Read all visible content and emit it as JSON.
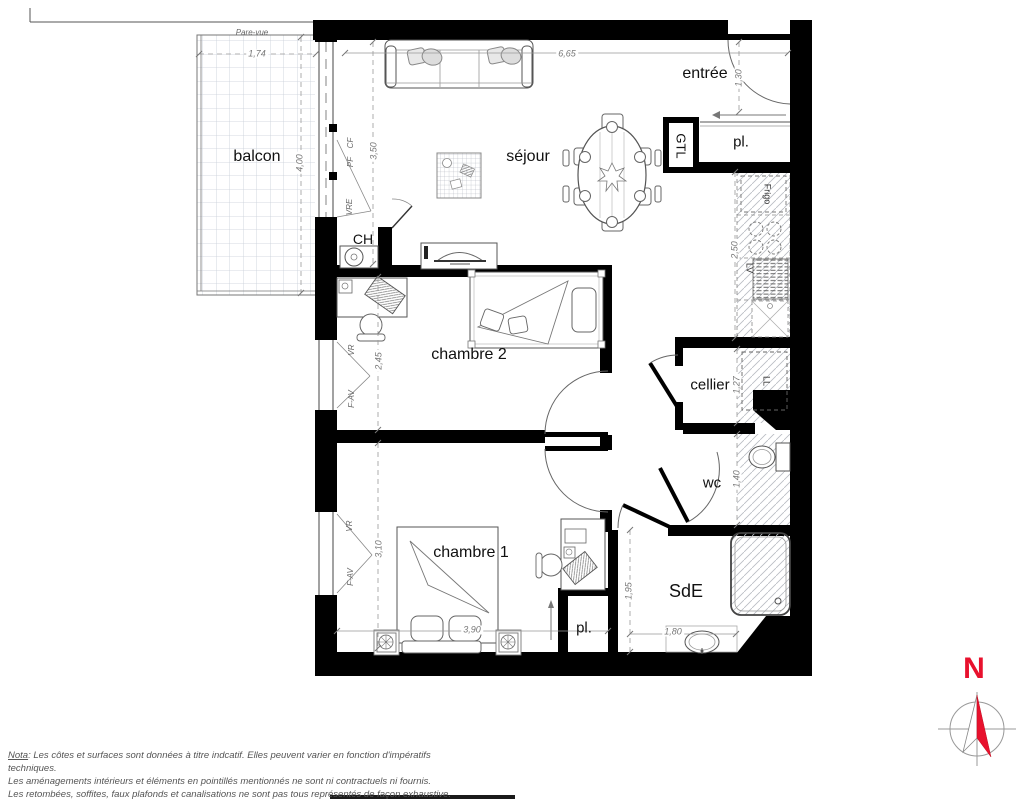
{
  "labels": {
    "balcon": "balcon",
    "sejour": "séjour",
    "entree": "entrée",
    "chambre2": "chambre 2",
    "chambre1": "chambre 1",
    "cellier": "cellier",
    "wc": "wc",
    "sde": "SdE",
    "pl_entree": "pl.",
    "pl_chambre1": "pl.",
    "ch": "CH",
    "gtl": "GTL",
    "pare_vue": "Pare-vue"
  },
  "dims": {
    "d174": "1,74",
    "d400": "4,00",
    "d350": "3,50",
    "d665": "6,65",
    "d130": "1,30",
    "d250": "2,50",
    "d245": "2,45",
    "d310": "3,10",
    "d390": "3,90",
    "d127": "1,27",
    "d140": "1,40",
    "d195": "1,95",
    "d180": "1,80"
  },
  "codes": {
    "vre": "VRE",
    "pf": "PF",
    "cf": "CF",
    "vr_ch2": "VR",
    "fav_ch2": "F-AV",
    "vr_ch1": "VR",
    "fav_ch1": "F-AV"
  },
  "appliances": {
    "frigo": "Frigo",
    "lv": "LV",
    "ll": "LL"
  },
  "compass": {
    "north": "N",
    "color": "#e8112d"
  },
  "notes": {
    "prefix": "Nota",
    "line1_rest": ": Les côtes et surfaces sont données à titre indcatif. Elles peuvent varier en fonction d'impératifs techniques.",
    "line2": "Les aménagements intérieurs et éléments en pointillés mentionnés ne sont ni contractuels ni fournis.",
    "line3": "Les retombées, soffites, faux plafonds et canalisations ne sont pas tous représentés de façon exhaustive."
  }
}
